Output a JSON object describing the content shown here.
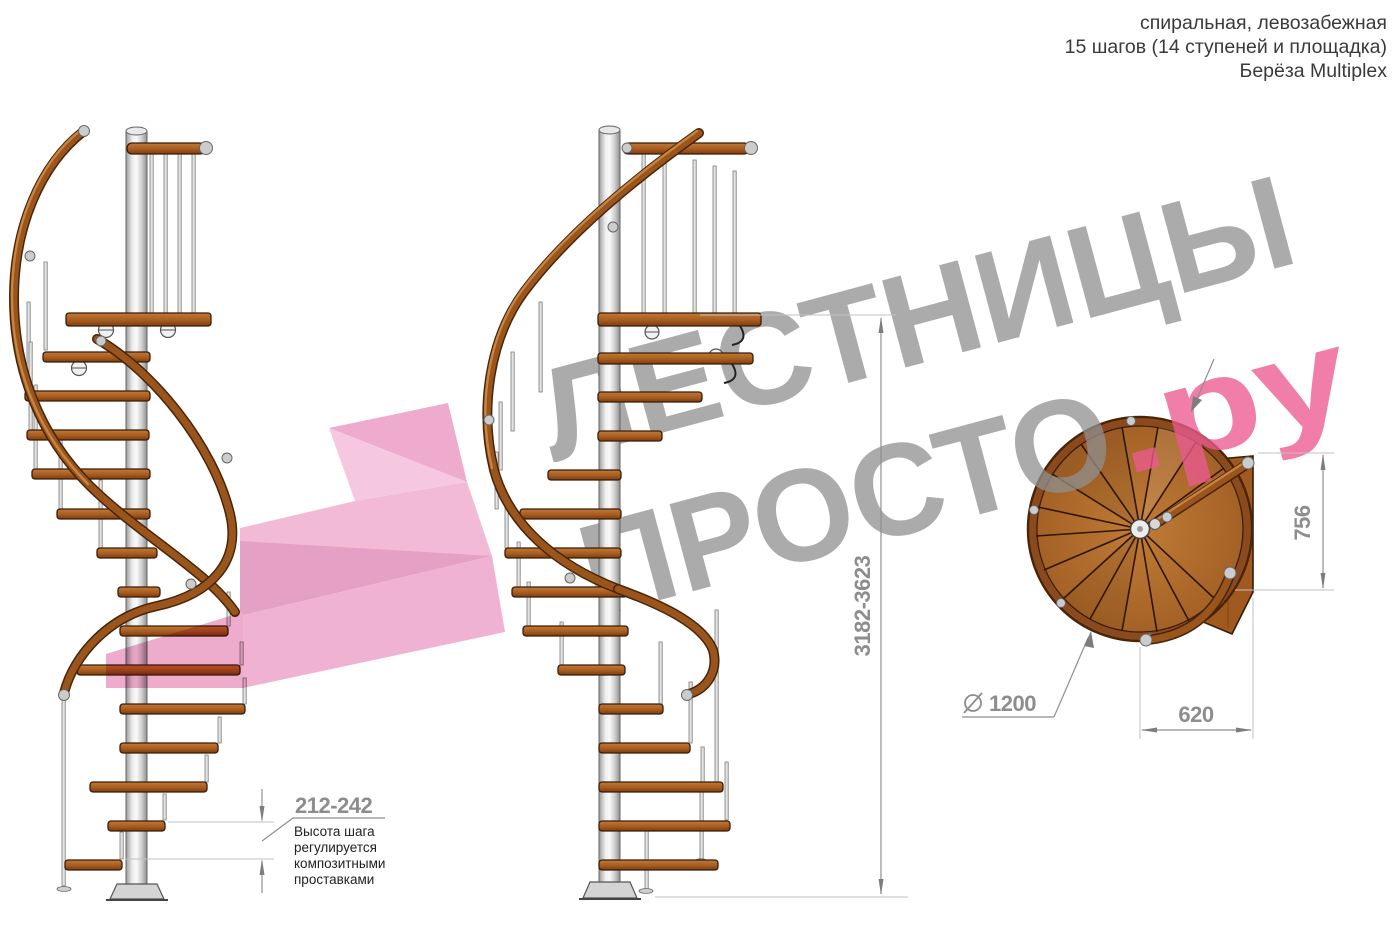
{
  "header": {
    "line1": "спиральная, левозабежная",
    "line2": "15 шагов (14 ступеней и площадка)",
    "line3": "Берёза Multiplex"
  },
  "watermark": {
    "line1": "ЛЕСТНИЦЫ",
    "line2_gray": "ПРОСТО",
    "line2_pink": ".ру"
  },
  "dimensions": {
    "step_height": {
      "value": "212-242",
      "note_lines": [
        "Высота шага",
        "регулируется",
        "композитными",
        "проставками"
      ]
    },
    "total_height": {
      "value": "3182-3623"
    },
    "plan_depth": {
      "value": "756"
    },
    "plan_width": {
      "value": "620"
    },
    "diameter": {
      "symbol": "⌀",
      "value": "1200"
    }
  },
  "colors": {
    "wood": "#a85c20",
    "wood_dark": "#4a2408",
    "metal": "#d9d9d9",
    "dimension_gray": "#8d8d8d",
    "watermark_gray": "#909090",
    "watermark_pink": "#ec5a90",
    "flag_pink": "#f2b5d3",
    "note_text": "#222222",
    "header_text": "#3a3a3a"
  }
}
